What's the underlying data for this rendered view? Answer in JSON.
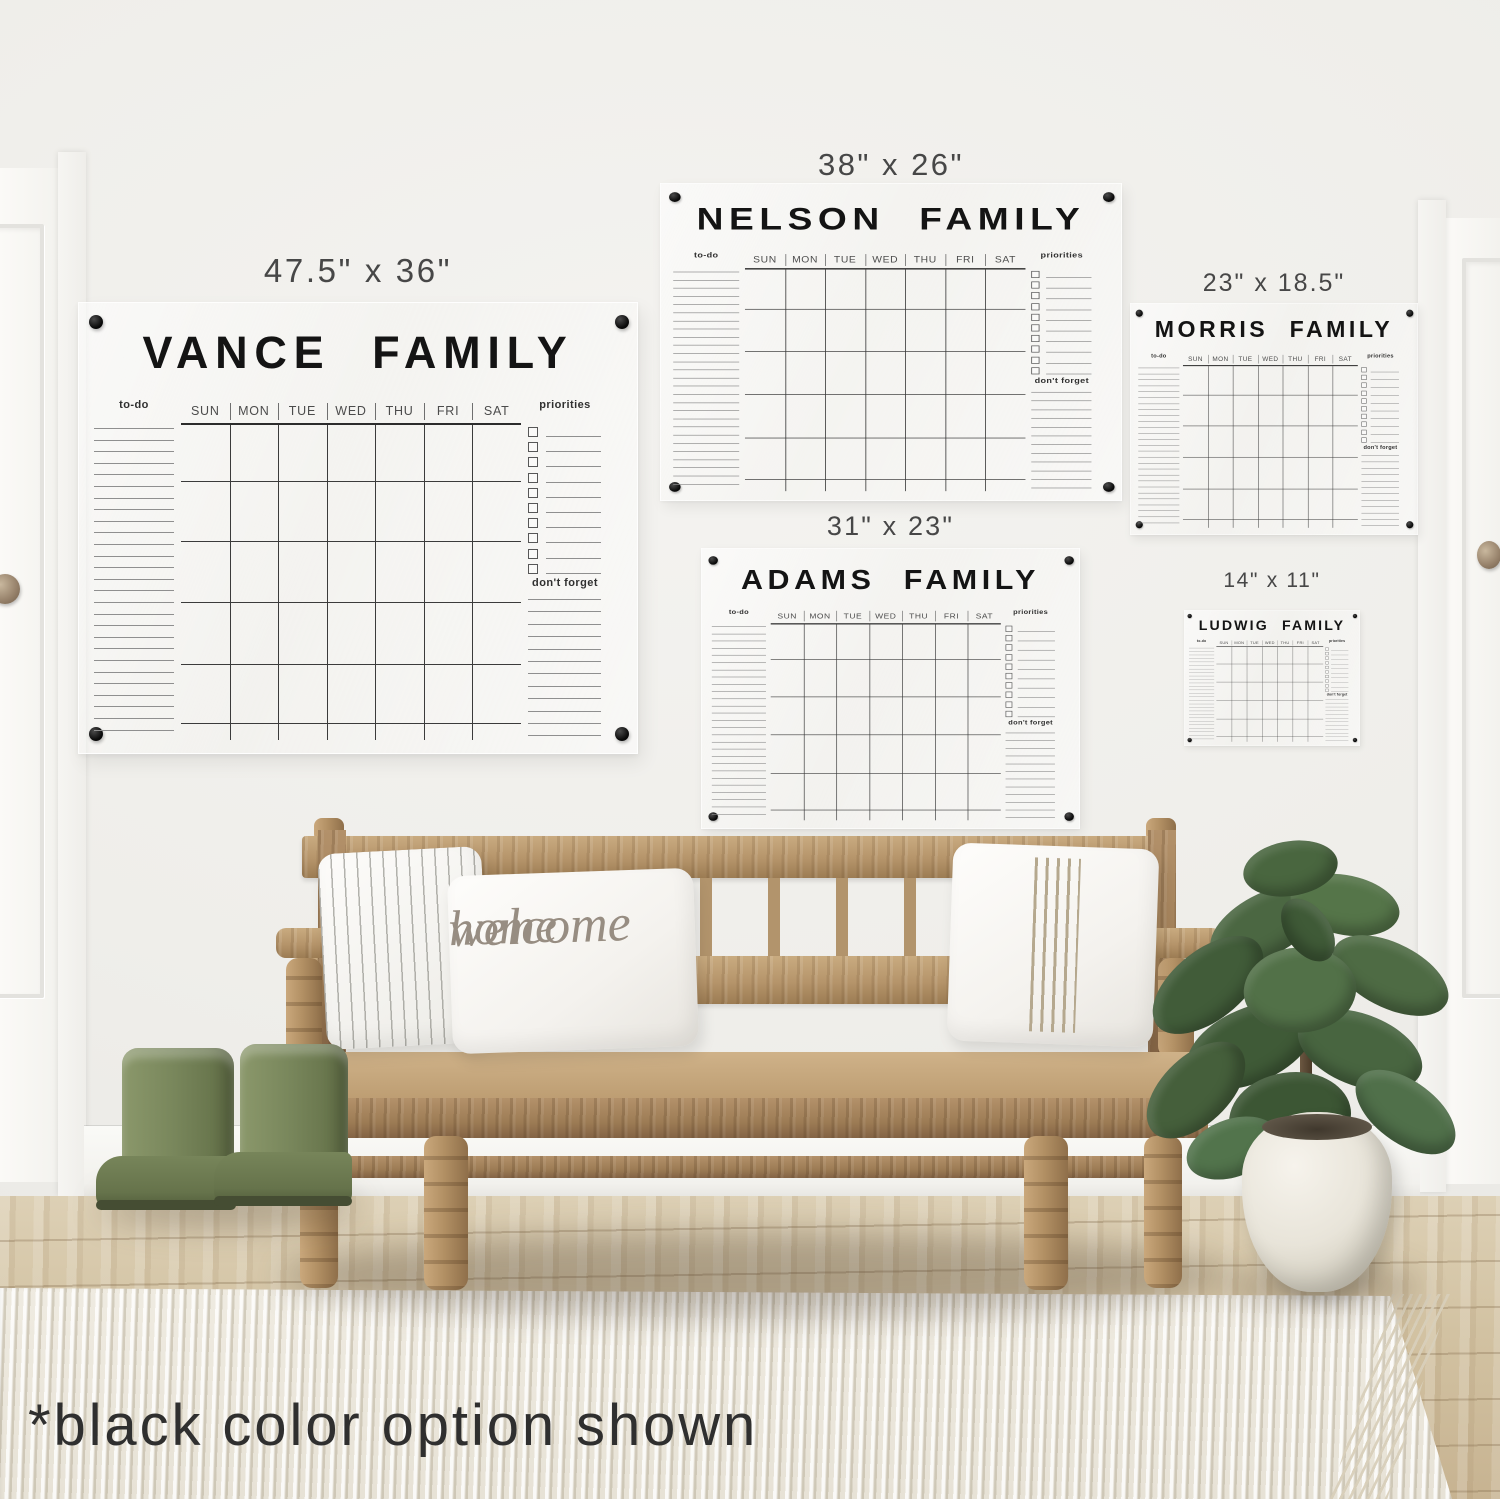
{
  "scene": {
    "footnote": "*black color option shown"
  },
  "pillow": {
    "line1": "welcome",
    "line2": "home"
  },
  "calendar_labels": {
    "todo": "to-do",
    "priorities": "priorities",
    "dont_forget": "don't forget",
    "days": [
      "SUN",
      "MON",
      "TUE",
      "WED",
      "THU",
      "FRI",
      "SAT"
    ]
  },
  "calendars": [
    {
      "id": "vance",
      "title": "VANCE FAMILY",
      "size_label": "47.5\" x 36\""
    },
    {
      "id": "nelson",
      "title": "NELSON FAMILY",
      "size_label": "38\" x 26\""
    },
    {
      "id": "morris",
      "title": "MORRIS FAMILY",
      "size_label": "23\" x 18.5\""
    },
    {
      "id": "adams",
      "title": "ADAMS FAMILY",
      "size_label": "31\" x 23\""
    },
    {
      "id": "ludwig",
      "title": "LUDWIG FAMILY",
      "size_label": "14\" x 11\""
    }
  ],
  "colors": {
    "wall": "#f1f0ed",
    "calendar_line_dark": "#3b3b3b",
    "calendar_line_light": "#8f8f8f",
    "calendar_text": "#141414",
    "mount_dot": "#0c0c0c",
    "wood": "#b5946a",
    "floor": "#d2c2a2",
    "rug": "#ece8dd",
    "boots_green": "#79875c",
    "leaf_green": "#4a6540",
    "pot_white": "#efece4"
  }
}
